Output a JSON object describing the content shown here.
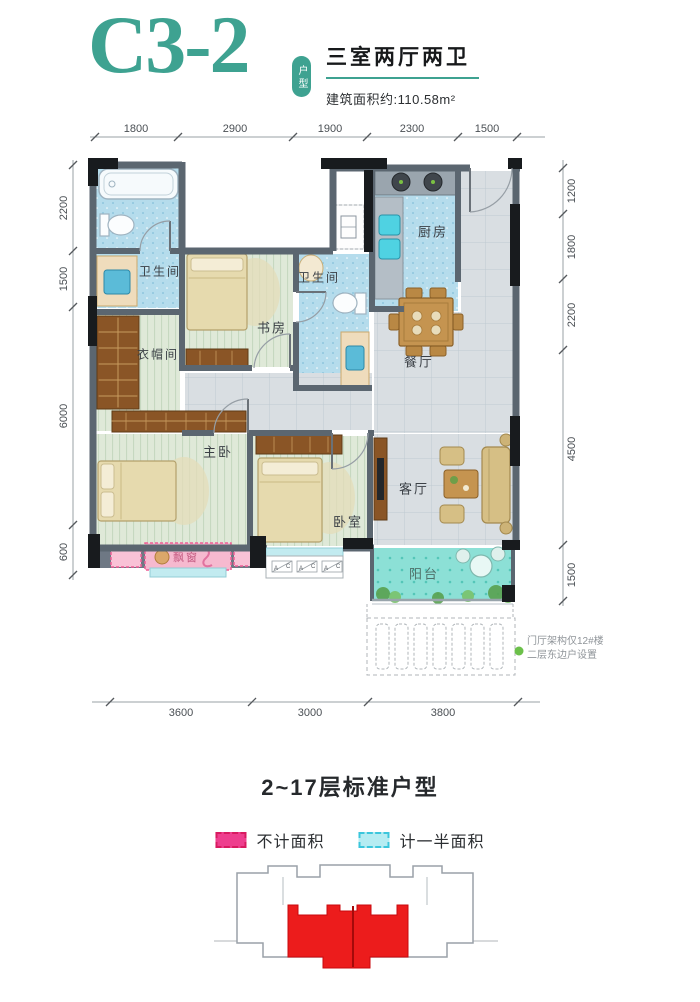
{
  "header": {
    "unit_code": "C3-2",
    "unit_badge": "户型",
    "layout_title": "三室两厅两卫",
    "area_text": "建筑面积约:110.58m²",
    "accent_color": "#3ea291"
  },
  "plan": {
    "rooms": [
      {
        "label": "卫生间"
      },
      {
        "label": "书房"
      },
      {
        "label": "卫生间"
      },
      {
        "label": "厨房"
      },
      {
        "label": "餐厅"
      },
      {
        "label": "衣帽间"
      },
      {
        "label": "主卧"
      },
      {
        "label": "卧室"
      },
      {
        "label": "客厅"
      },
      {
        "label": "阳台"
      },
      {
        "label": "飘窗"
      }
    ],
    "window_marks": [
      "A",
      "C"
    ],
    "note": {
      "line1": "门厅架构仅12#楼",
      "line2": "二层东边户设置",
      "dot_color": "#6cc04a"
    }
  },
  "dimensions": {
    "top": [
      "1800",
      "2900",
      "1900",
      "2300",
      "1500"
    ],
    "left": [
      "2200",
      "1500",
      "6000",
      "600"
    ],
    "right": [
      "1200",
      "1800",
      "2200",
      "4500",
      "1500"
    ],
    "bottom": [
      "3600",
      "3000",
      "3800"
    ]
  },
  "footer": {
    "floor_title": "2~17层标准户型",
    "legend": [
      {
        "label": "不计面积",
        "color": "#ee3f8e"
      },
      {
        "label": "计一半面积",
        "color": "#b5ecf2"
      }
    ],
    "building_highlight_color": "#ec1c1c"
  }
}
